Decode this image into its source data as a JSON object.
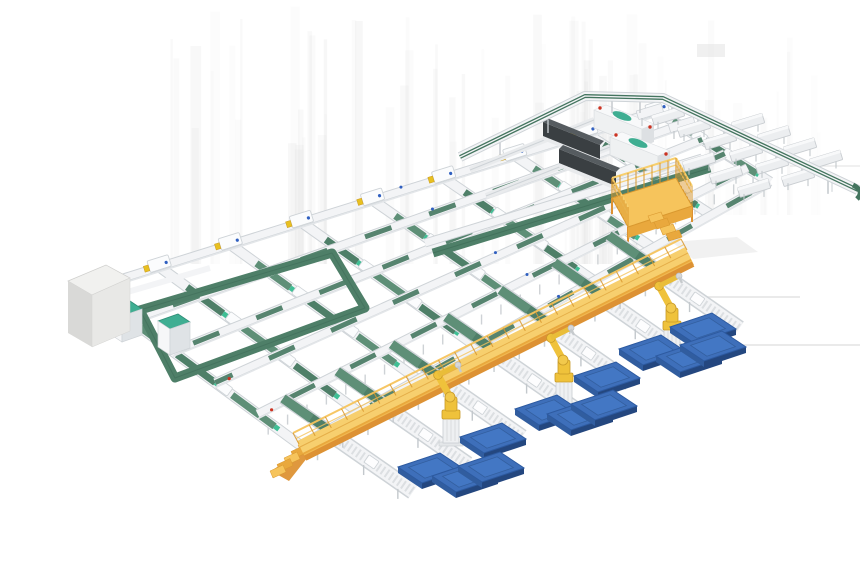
{
  "meta": {
    "title": "Automated sortation and palletizing system - 3D render",
    "canvas": {
      "width": 860,
      "height": 580
    },
    "background": "#ffffff"
  },
  "scene": {
    "description": "Isometric 3D illustration of an automated parcel sortation line: a cross-belt conveyor grid with shuttle carriers, a loop sorter with induction cabinets, an infeed machine cabinet, two dark telescopic boom loaders, an elevated sorter spine with discharge chutes, a yellow maintenance platform with stairs, a long yellow operator walkway with stairs and roller spur conveyors, yellow palletizing robots on pedestals, and blue floor pallets.",
    "equipment": [
      {
        "name": "conveyor-grid",
        "label": "Cross-belt conveyor grid"
      },
      {
        "name": "sorter-loop",
        "label": "Loop sorter with induction cabinets"
      },
      {
        "name": "infeed-machine",
        "label": "Infeed machine cabinet"
      },
      {
        "name": "telescopic-loaders",
        "label": "Telescopic boom loaders"
      },
      {
        "name": "sorter-spine",
        "label": "Elevated sorter spine with discharge chutes"
      },
      {
        "name": "maintenance-platform",
        "label": "Maintenance platform with stairs"
      },
      {
        "name": "operator-walkway",
        "label": "Elevated operator walkway with roller spurs"
      },
      {
        "name": "palletizing-robots",
        "label": "Palletizing robots"
      },
      {
        "name": "pallets",
        "label": "Floor pallets"
      }
    ],
    "counts": {
      "grid_lanes": 6,
      "grid_cross_lines": 9,
      "shuttle_carriers": 8,
      "loop_cabinets": 2,
      "telescopic_loaders": 2,
      "chutes_upper": 4,
      "chutes_lower": 9,
      "walkway_spurs": 7,
      "palletizing_robots": 3,
      "pallets": 12
    }
  },
  "colors": {
    "belt_green": "#4e7f68",
    "belt_green_light": "#5e8f77",
    "belt_green_dark": "#3c6a55",
    "teal_accent": "#3fae92",
    "teal_bright": "#3fbf95",
    "frame_white": "#f3f4f6",
    "frame_edge": "#ced3d7",
    "leg_gray": "#c3c8cc",
    "machine_dark": "#3a3f42",
    "machine_dark_hi": "#565c60",
    "machine_head": "#eff1f2",
    "amber": "#f6c45c",
    "amber_deep": "#e9a83d",
    "amber_dark": "#dd9234",
    "amber_light": "#f7cf6e",
    "amber_edge": "#d9982f",
    "robot_yellow": "#efc23b",
    "robot_yellow_dark": "#c89a28",
    "pedestal": "#eef0f2",
    "pedestal_edge": "#c8cdd1",
    "pallet_top": "#3e6fba",
    "pallet_mid": "#315d9f",
    "pallet_side": "#24477f",
    "pallet_edge": "#2d5aa0",
    "dot_red": "#cc3322",
    "dot_blue": "#2f5fc0",
    "dot_yellow": "#e8c020",
    "streak": "#dcdcdc",
    "gray_box_top": "#f1f1ef",
    "gray_box_front": "#d9d9d7",
    "gray_box_side": "#e8e8e6"
  }
}
